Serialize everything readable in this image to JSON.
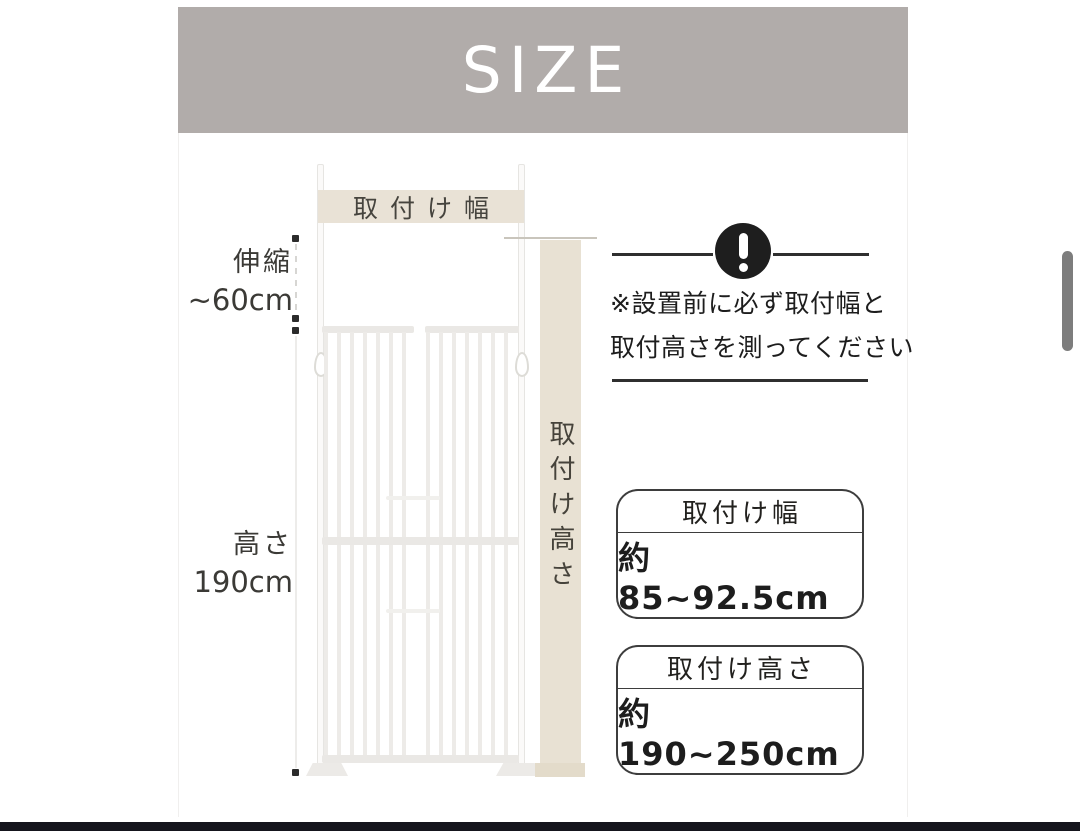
{
  "banner": {
    "label": "SIZE",
    "bg": "#b1acaa"
  },
  "diagram": {
    "gate": {
      "width_label": "取付け幅",
      "extension_label_line1": "伸縮",
      "extension_label_line2": "~60cm",
      "height_label_line1": "高さ",
      "height_label_line2": "190cm"
    },
    "column": {
      "vertical_label": "取付け高さ"
    }
  },
  "notice": {
    "icon": "exclamation-icon",
    "line1": "※設置前に必ず取付幅と",
    "line2": "取付高さを測ってください"
  },
  "spec_boxes": [
    {
      "title": "取付け幅",
      "value": "約85~92.5cm"
    },
    {
      "title": "取付け高さ",
      "value": "約190~250cm"
    }
  ],
  "colors": {
    "banner_bg": "#b1acaa",
    "beige_label": "#e9e2d6",
    "beige_column": "#e8e1d3",
    "gate_gray": "#eae8e5",
    "ink": "#1d1d1d",
    "box_border": "#3d3d3d",
    "scrollbar": "#7d7d7d",
    "bottom_bar": "#15151d"
  }
}
